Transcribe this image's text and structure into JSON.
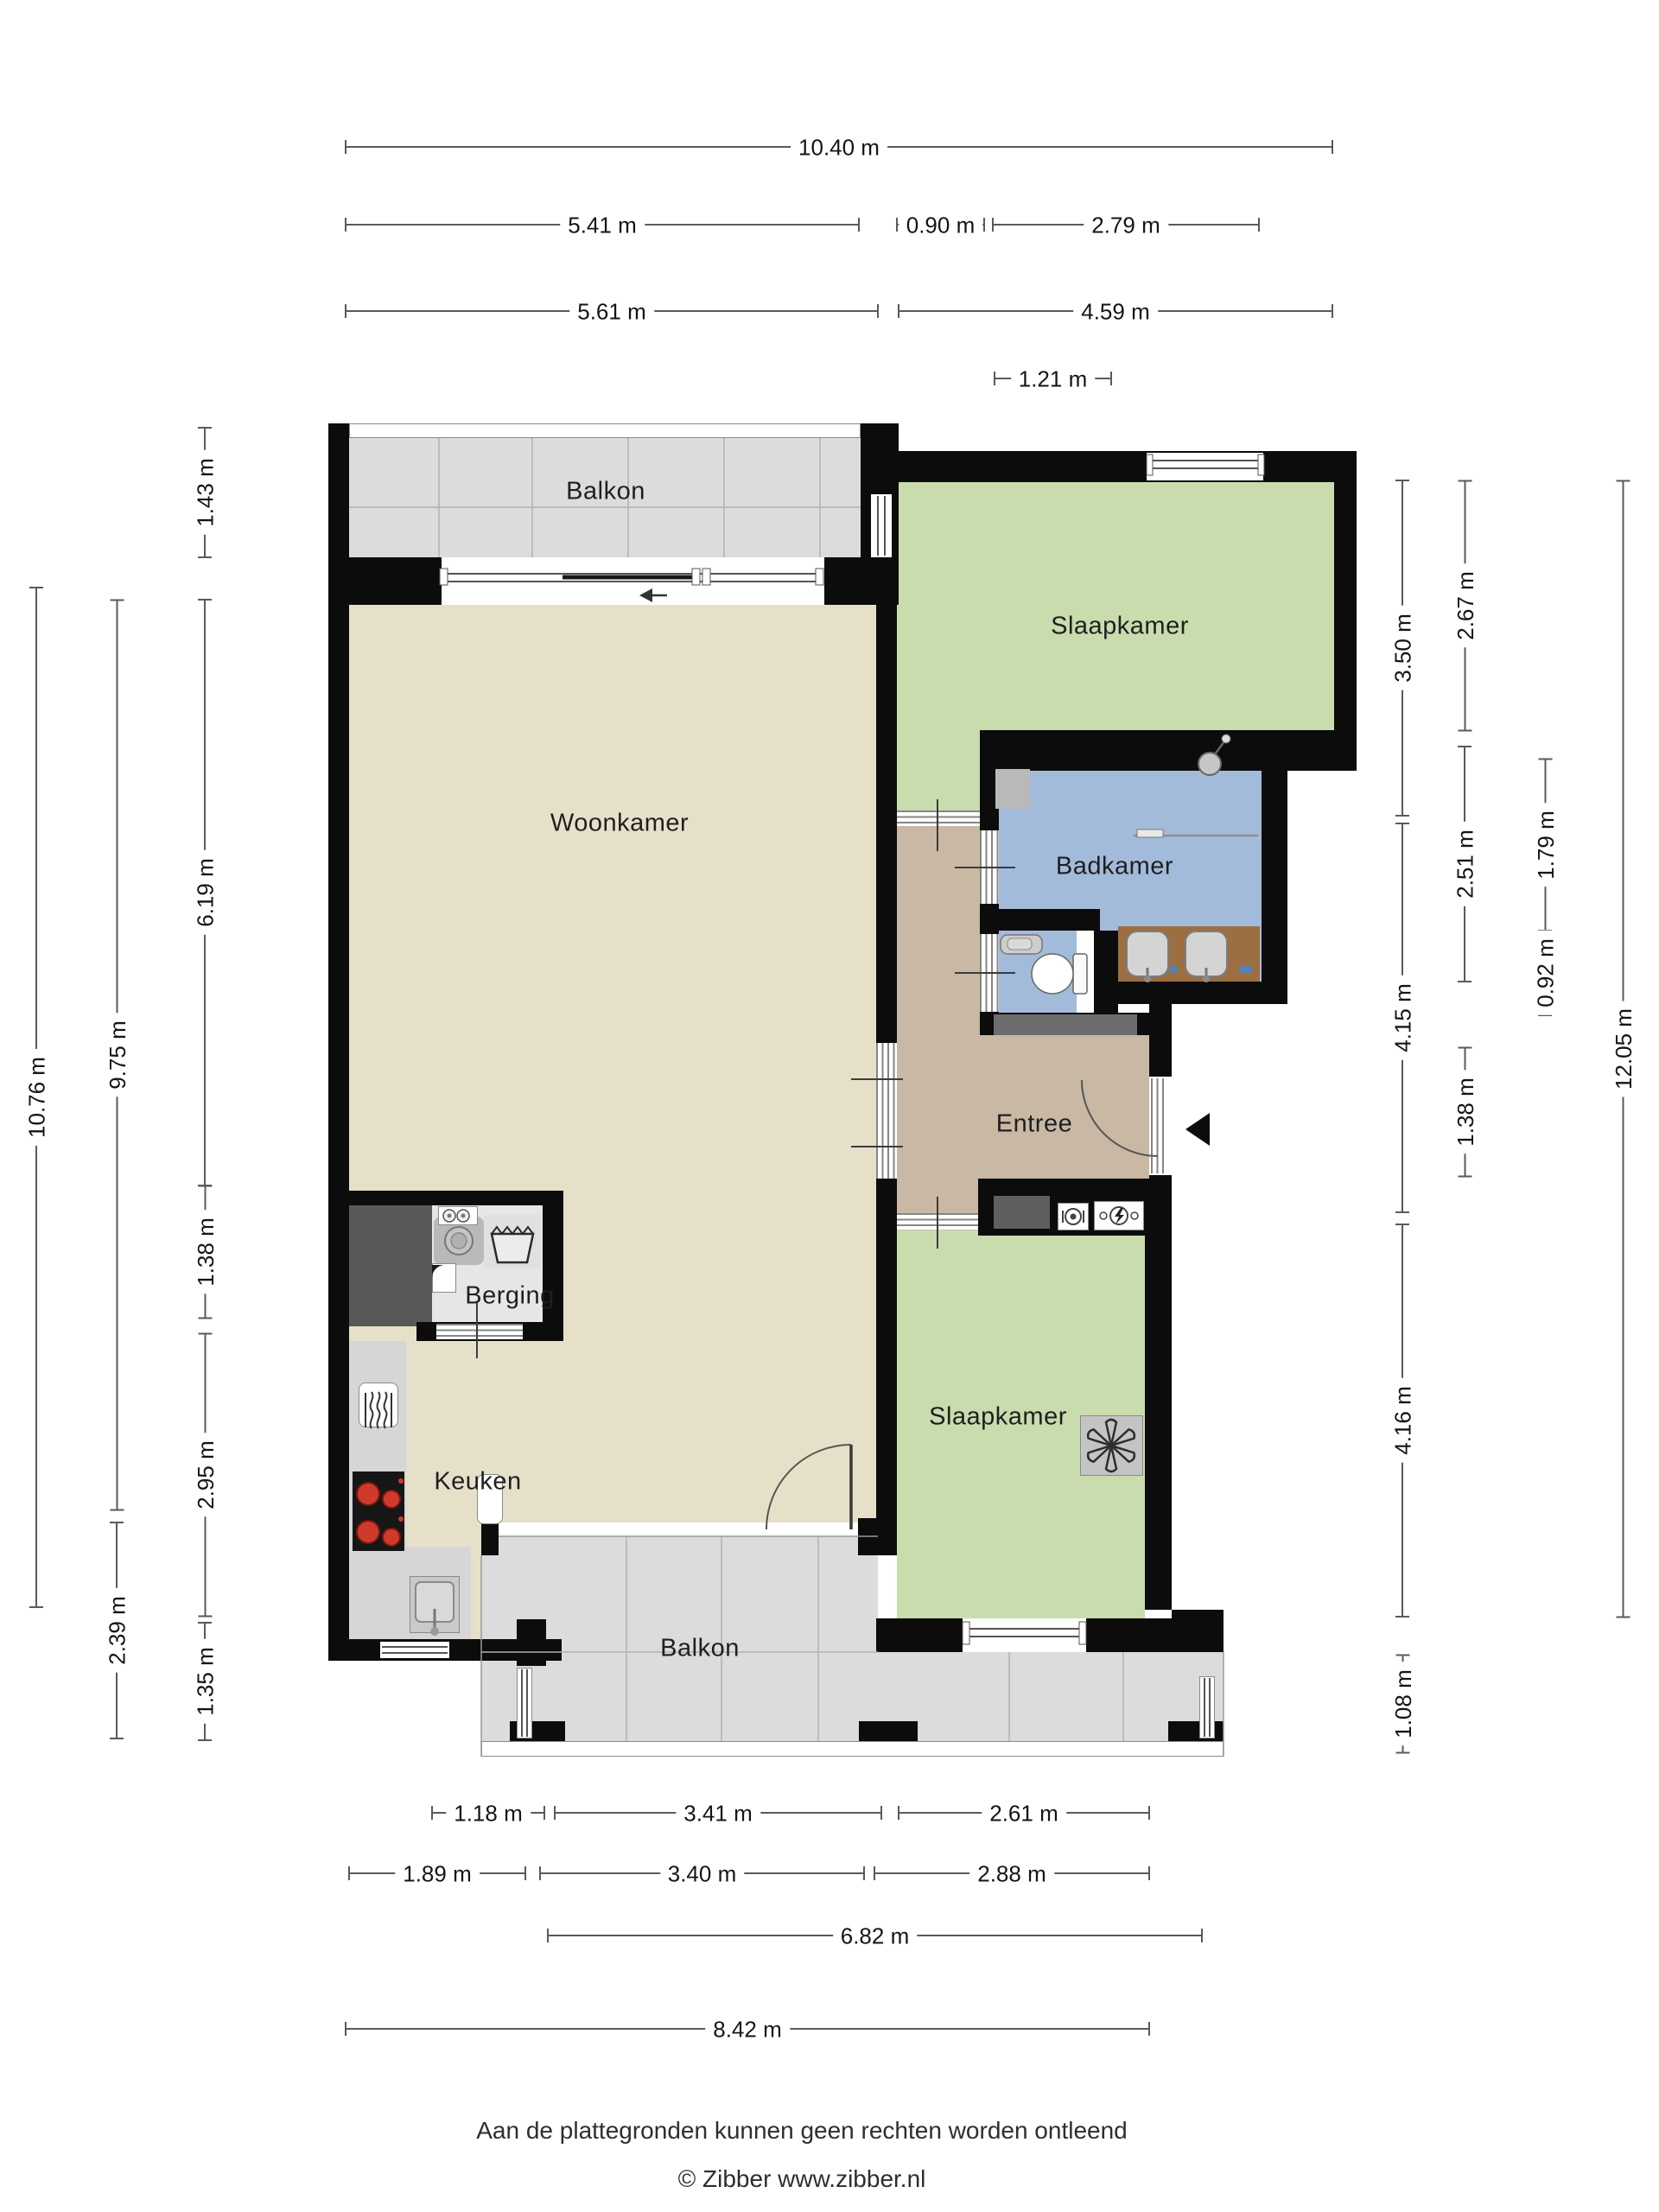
{
  "rooms": {
    "balkon_top": "Balkon",
    "slaapkamer_top": "Slaapkamer",
    "woonkamer": "Woonkamer",
    "badkamer": "Badkamer",
    "entree": "Entree",
    "berging": "Berging",
    "keuken": "Keuken",
    "slaapkamer_bottom": "Slaapkamer",
    "balkon_bottom": "Balkon"
  },
  "dimensions": {
    "top": [
      {
        "id": "t1",
        "label": "10.40 m"
      },
      {
        "id": "t2",
        "label": "5.41 m"
      },
      {
        "id": "t3",
        "label": "0.90 m"
      },
      {
        "id": "t4",
        "label": "2.79 m"
      },
      {
        "id": "t5",
        "label": "5.61 m"
      },
      {
        "id": "t6",
        "label": "4.59 m"
      },
      {
        "id": "t7",
        "label": "1.21 m"
      }
    ],
    "left": [
      {
        "id": "l1",
        "label": "10.76 m"
      },
      {
        "id": "l2",
        "label": "9.75 m"
      },
      {
        "id": "l3",
        "label": "2.39 m"
      },
      {
        "id": "l4",
        "label": "1.43 m"
      },
      {
        "id": "l5",
        "label": "6.19 m"
      },
      {
        "id": "l6",
        "label": "1.38 m"
      },
      {
        "id": "l7",
        "label": "2.95 m"
      },
      {
        "id": "l8",
        "label": "1.35 m"
      }
    ],
    "right": [
      {
        "id": "r1",
        "label": "3.50 m"
      },
      {
        "id": "r2",
        "label": "4.15 m"
      },
      {
        "id": "r3",
        "label": "4.16 m"
      },
      {
        "id": "r4",
        "label": "1.08 m"
      },
      {
        "id": "r5",
        "label": "2.67 m"
      },
      {
        "id": "r6",
        "label": "2.51 m"
      },
      {
        "id": "r7",
        "label": "1.38 m"
      },
      {
        "id": "r8",
        "label": "1.79 m"
      },
      {
        "id": "r9",
        "label": "0.92 m"
      },
      {
        "id": "r10",
        "label": "12.05 m"
      }
    ],
    "bottom": [
      {
        "id": "b1",
        "label": "1.18 m"
      },
      {
        "id": "b2",
        "label": "3.41 m"
      },
      {
        "id": "b3",
        "label": "2.61 m"
      },
      {
        "id": "b4",
        "label": "1.89 m"
      },
      {
        "id": "b5",
        "label": "3.40 m"
      },
      {
        "id": "b6",
        "label": "2.88 m"
      },
      {
        "id": "b7",
        "label": "6.82 m"
      },
      {
        "id": "b8",
        "label": "8.42 m"
      }
    ]
  },
  "footer": {
    "disclaimer": "Aan de plattegronden kunnen geen rechten worden ontleend",
    "copyright": "© Zibber www.zibber.nl"
  },
  "colors": {
    "walls": "#0c0c0c",
    "living": "#e7e0c9",
    "bedroom": "#c8dcae",
    "bathroom": "#a3bbda",
    "hallway": "#c8b8a4",
    "balcony": "#dcdcdc",
    "storage": "#e6e6e6",
    "counter": "#d6d6d6",
    "cabinet": "#585858",
    "cabinet2": "#5f5f5f",
    "fixture": "#b9b9b9",
    "vanity": "#9b6f42",
    "fanbox": "#c4c4c4",
    "darkstrip": "#6d6d6d",
    "basketbox": "#e0e0e0",
    "accent_red": "#cf3a2a"
  }
}
